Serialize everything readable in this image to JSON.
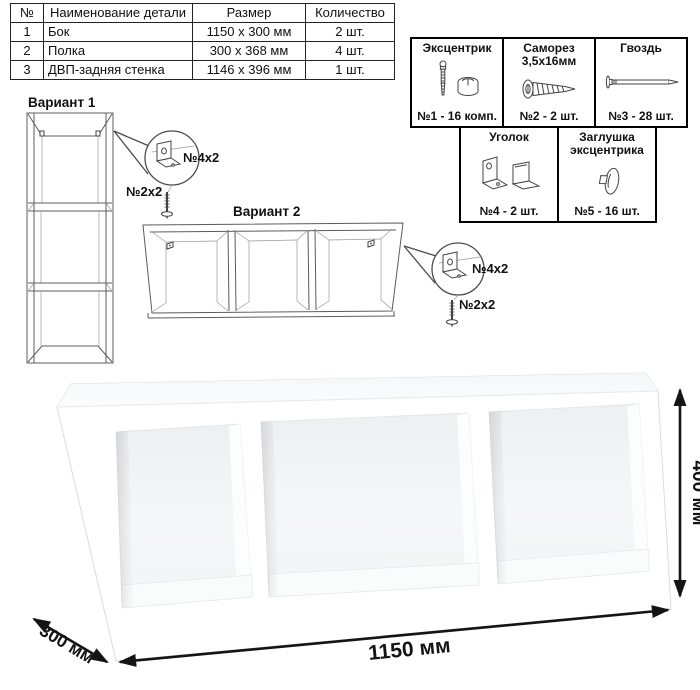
{
  "parts_table": {
    "headers": {
      "num": "№",
      "name": "Наименование детали",
      "size": "Размер",
      "qty": "Количество"
    },
    "rows": [
      {
        "num": "1",
        "name": "Бок",
        "size": "1150 x 300 мм",
        "qty": "2 шт."
      },
      {
        "num": "2",
        "name": "Полка",
        "size": "300 x 368 мм",
        "qty": "4 шт."
      },
      {
        "num": "3",
        "name": "ДВП-задняя стенка",
        "size": "1146 x 396 мм",
        "qty": "1 шт."
      }
    ]
  },
  "hardware": {
    "cam": {
      "title": "Эксцентрик",
      "icon": "cam-and-dowel-icon",
      "count": "№1 - 16 комп."
    },
    "screw": {
      "title": "Саморез 3,5х16мм",
      "icon": "screw-icon",
      "count": "№2 - 2 шт."
    },
    "nail": {
      "title": "Гвоздь",
      "icon": "nail-icon",
      "count": "№3 - 28 шт."
    },
    "bracket": {
      "title": "Уголок",
      "icon": "corner-bracket-icon",
      "count": "№4 - 2 шт."
    },
    "cap": {
      "title": "Заглушка эксцентрика",
      "icon": "cam-cap-icon",
      "count": "№5 - 16 шт."
    }
  },
  "variant1": {
    "title": "Вариант 1",
    "bracket_label": "№4х2",
    "screw_label": "№2х2"
  },
  "variant2": {
    "title": "Вариант 2",
    "bracket_label": "№4х2",
    "screw_label": "№2х2"
  },
  "dimensions": {
    "height": "400 мм",
    "length": "1150 мм",
    "depth": "300 мм"
  },
  "colors": {
    "line": "#000000",
    "drawing_line": "#5c5c5c",
    "text": "#111111",
    "background": "#ffffff"
  }
}
